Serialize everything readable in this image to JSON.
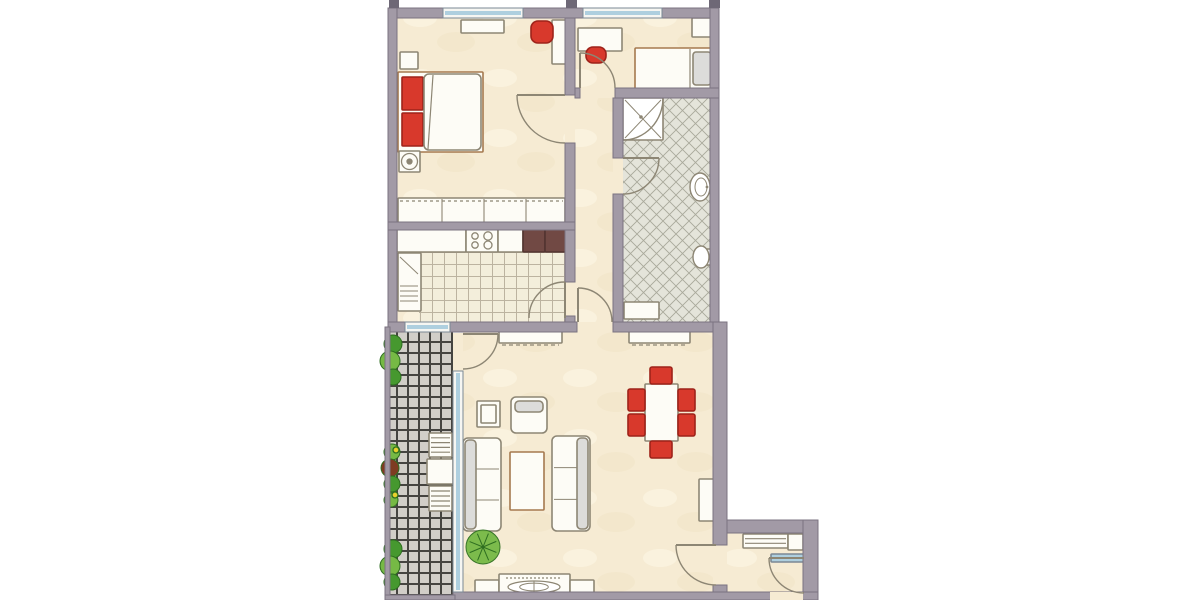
{
  "palette": {
    "wall": "#a29aa6",
    "wallEdge": "#7b7380",
    "stub": "#6e6876",
    "furn": "#fdfcf6",
    "line": "#8d8674",
    "tan": "#a5794f",
    "red": "#d8392c",
    "redDark": "#9e231a",
    "darkCounter": "#714944",
    "darkCounterStroke": "#533430",
    "grayLight": "#dcdcda",
    "windowBlue": "#aecfdf",
    "winFrame": "#f6f6f2",
    "sillStroke": "#7b8894",
    "green": "#46982f",
    "greenDark": "#2e6e20",
    "greenLight": "#76b945",
    "brownRed": "#7e3b22",
    "yellow": "#e8d12c",
    "cream": "#f6ebd3",
    "doorArc": "#8d8674",
    "white": "#ffffff"
  },
  "canvas": {
    "w": 1200,
    "h": 600
  },
  "floors": [
    {
      "n": "floor-bedroom",
      "r": [
        397,
        18,
        168,
        204
      ],
      "f": "cream"
    },
    {
      "n": "floor-kids-room",
      "r": [
        575,
        18,
        135,
        70
      ],
      "f": "cream"
    },
    {
      "n": "floor-hallway",
      "r": [
        575,
        88,
        38,
        234
      ],
      "f": "cream"
    },
    {
      "n": "floor-bathroom",
      "r": [
        623,
        98,
        87,
        224
      ],
      "f": "bath"
    },
    {
      "n": "floor-kitchen",
      "r": [
        397,
        230,
        168,
        92
      ],
      "f": "cream"
    },
    {
      "n": "floor-kitchen-tiles",
      "r": [
        419,
        252,
        146,
        70
      ],
      "f": "checker"
    },
    {
      "n": "floor-living-room",
      "r": [
        463,
        332,
        250,
        260
      ],
      "f": "cream"
    },
    {
      "n": "floor-entry",
      "r": [
        727,
        533,
        76,
        59
      ],
      "f": "cream"
    },
    {
      "n": "floor-balcony",
      "r": [
        390,
        330,
        63,
        266
      ],
      "f": "balcony"
    },
    {
      "n": "gap-bedroom-door",
      "r": [
        565,
        95,
        10,
        48
      ],
      "f": "flat"
    },
    {
      "n": "gap-kids-door",
      "r": [
        580,
        88,
        35,
        10
      ],
      "f": "flat"
    },
    {
      "n": "gap-bath-door",
      "r": [
        613,
        158,
        10,
        36
      ],
      "f": "flat"
    },
    {
      "n": "gap-kitchen-door",
      "r": [
        565,
        282,
        10,
        34
      ],
      "f": "flat"
    },
    {
      "n": "gap-hall-living-door",
      "r": [
        577,
        322,
        36,
        10
      ],
      "f": "flat"
    },
    {
      "n": "gap-balcony-door",
      "r": [
        453,
        333,
        10,
        38
      ],
      "f": "flat"
    },
    {
      "n": "gap-living-entry-door",
      "r": [
        713,
        545,
        14,
        40
      ],
      "f": "flat"
    }
  ],
  "furniture": [
    {
      "t": "rect",
      "n": "nightstand",
      "r": [
        400,
        52,
        18,
        17
      ]
    },
    {
      "t": "rect",
      "n": "double-bed-frame",
      "r": [
        398,
        72,
        85,
        80
      ],
      "stroke": "tan"
    },
    {
      "t": "rect",
      "n": "bed-pillow-1",
      "r": [
        402,
        77,
        21,
        33
      ],
      "fill": "red",
      "stroke": "redDark"
    },
    {
      "t": "rect",
      "n": "bed-pillow-2",
      "r": [
        402,
        113,
        21,
        33
      ],
      "fill": "red",
      "stroke": "redDark"
    },
    {
      "t": "rect",
      "n": "bed-duvet",
      "r": [
        424,
        74,
        57,
        76
      ],
      "rx": 5
    },
    {
      "t": "line",
      "n": "duvet-fold",
      "p": [
        433,
        75,
        428,
        149
      ]
    },
    {
      "t": "rect",
      "n": "stool-base",
      "r": [
        399,
        151,
        21,
        21
      ]
    },
    {
      "t": "circle",
      "n": "stool-seat",
      "c": [
        409.5,
        161.5,
        8
      ]
    },
    {
      "t": "circle",
      "n": "stool-knob",
      "c": [
        409.5,
        161.5,
        2.5
      ],
      "fill": "line"
    },
    {
      "t": "rect",
      "n": "wall-shelf-bedroom",
      "r": [
        461,
        20,
        43,
        13
      ]
    },
    {
      "t": "rect",
      "n": "desk-bedroom",
      "r": [
        552,
        20,
        15,
        44
      ]
    },
    {
      "t": "chairRed",
      "n": "office-chair-bedroom",
      "r": [
        531,
        21,
        22,
        22
      ],
      "round": true
    },
    {
      "t": "rectLines",
      "n": "wardrobe-row",
      "r": [
        398,
        198,
        167,
        25
      ],
      "vlines": [
        442,
        484,
        526
      ]
    },
    {
      "t": "line",
      "n": "wardrobe-rail",
      "p": [
        400,
        201,
        563,
        201
      ],
      "dash": "3,3"
    },
    {
      "t": "rect",
      "n": "desk-kids",
      "r": [
        578,
        28,
        44,
        23
      ]
    },
    {
      "t": "chairRed",
      "n": "chair-kids",
      "r": [
        586,
        47,
        20,
        16
      ],
      "round": true
    },
    {
      "t": "rect",
      "n": "single-bed-kids",
      "r": [
        635,
        48,
        78,
        41
      ],
      "stroke": "tan"
    },
    {
      "t": "line",
      "n": "single-bed-line",
      "p": [
        690,
        49,
        690,
        88
      ]
    },
    {
      "t": "rect",
      "n": "pillow-kids",
      "r": [
        693,
        52,
        18,
        33
      ],
      "fill": "grayLight",
      "rx": 3
    },
    {
      "t": "rect",
      "n": "wardrobe-kids",
      "r": [
        692,
        18,
        20,
        19
      ]
    },
    {
      "t": "shower",
      "n": "shower",
      "r": [
        623,
        98,
        40,
        42
      ]
    },
    {
      "t": "sink",
      "n": "sink",
      "c": [
        700,
        187,
        10,
        14
      ]
    },
    {
      "t": "toilet",
      "n": "toilet",
      "c": [
        701,
        257,
        8,
        11
      ]
    },
    {
      "t": "rect",
      "n": "bath-cabinet",
      "r": [
        624,
        302,
        35,
        17
      ]
    },
    {
      "t": "rect",
      "n": "kitchen-counter-left",
      "r": [
        397,
        229,
        69,
        23
      ]
    },
    {
      "t": "stove",
      "n": "stove",
      "r": [
        466,
        229,
        32,
        23
      ]
    },
    {
      "t": "rect",
      "n": "kitchen-counter-mid",
      "r": [
        498,
        229,
        25,
        23
      ]
    },
    {
      "t": "rect",
      "n": "kitchen-counter-dark-1",
      "r": [
        523,
        229,
        22,
        23
      ],
      "fill": "darkCounter",
      "stroke": "darkCounterStroke"
    },
    {
      "t": "rect",
      "n": "kitchen-counter-dark-2",
      "r": [
        545,
        229,
        21,
        23
      ],
      "fill": "darkCounter",
      "stroke": "darkCounterStroke"
    },
    {
      "t": "fridge",
      "n": "fridge",
      "r": [
        398,
        253,
        23,
        58
      ]
    },
    {
      "t": "rect",
      "n": "sideboard-1",
      "r": [
        499,
        329,
        63,
        14
      ]
    },
    {
      "t": "line",
      "n": "sideboard-1-edge",
      "p": [
        502,
        345,
        559,
        345
      ],
      "dash": "4,3"
    },
    {
      "t": "rect",
      "n": "sideboard-2",
      "r": [
        629,
        329,
        61,
        14
      ]
    },
    {
      "t": "line",
      "n": "sideboard-2-edge",
      "p": [
        632,
        345,
        687,
        345
      ],
      "dash": "4,3"
    },
    {
      "t": "rect",
      "n": "dining-table",
      "r": [
        645,
        384,
        33,
        57
      ]
    },
    {
      "t": "chairRed",
      "n": "dining-chair-top",
      "r": [
        650,
        367,
        22,
        17
      ]
    },
    {
      "t": "chairRed",
      "n": "dining-chair-bottom",
      "r": [
        650,
        441,
        22,
        17
      ]
    },
    {
      "t": "chairRed",
      "n": "dining-chair-left-1",
      "r": [
        628,
        389,
        17,
        22
      ]
    },
    {
      "t": "chairRed",
      "n": "dining-chair-left-2",
      "r": [
        628,
        414,
        17,
        22
      ]
    },
    {
      "t": "chairRed",
      "n": "dining-chair-right-1",
      "r": [
        678,
        389,
        17,
        22
      ]
    },
    {
      "t": "chairRed",
      "n": "dining-chair-right-2",
      "r": [
        678,
        414,
        17,
        22
      ]
    },
    {
      "t": "armchair",
      "n": "armchair",
      "r": [
        511,
        397,
        36,
        36
      ]
    },
    {
      "t": "rect",
      "n": "side-table",
      "r": [
        477,
        401,
        23,
        26
      ]
    },
    {
      "t": "rect",
      "n": "side-table-top",
      "r": [
        481,
        405,
        15,
        18
      ]
    },
    {
      "t": "sofa",
      "n": "sofa-left",
      "r": [
        463,
        438,
        38,
        93
      ],
      "back": "left"
    },
    {
      "t": "sofa",
      "n": "sofa-right",
      "r": [
        552,
        436,
        38,
        95
      ],
      "back": "right"
    },
    {
      "t": "rect",
      "n": "coffee-table",
      "r": [
        510,
        452,
        34,
        58
      ],
      "stroke": "tan"
    },
    {
      "t": "plantBurst",
      "n": "plant-living",
      "c": [
        483,
        547,
        17
      ]
    },
    {
      "t": "rect",
      "n": "tv-unit-left",
      "r": [
        475,
        580,
        24,
        18
      ]
    },
    {
      "t": "rect",
      "n": "tv-unit-center",
      "r": [
        499,
        574,
        71,
        24
      ]
    },
    {
      "t": "rect",
      "n": "tv-unit-right",
      "r": [
        570,
        580,
        24,
        18
      ]
    },
    {
      "t": "deco",
      "n": "stereo-deco",
      "c": [
        534,
        587,
        26,
        6
      ]
    },
    {
      "t": "line",
      "n": "tv-dash",
      "p": [
        506,
        578,
        562,
        578
      ],
      "dash": "2,2"
    },
    {
      "t": "rect",
      "n": "cabinet-living",
      "r": [
        699,
        479,
        16,
        42
      ]
    },
    {
      "t": "rectLines",
      "n": "entry-shelf",
      "r": [
        743,
        534,
        45,
        14
      ],
      "hlines": 2
    },
    {
      "t": "rect",
      "n": "entry-box",
      "r": [
        788,
        534,
        15,
        16
      ]
    },
    {
      "t": "rect",
      "n": "entry-mat",
      "r": [
        771,
        554,
        35,
        8
      ],
      "fill": "windowBlue",
      "stroke": "sillStroke"
    },
    {
      "t": "rect",
      "n": "balcony-table",
      "r": [
        427,
        459,
        26,
        25
      ]
    },
    {
      "t": "rectLines",
      "n": "balcony-chair-1",
      "r": [
        429,
        433,
        23,
        24
      ],
      "hlines": 4
    },
    {
      "t": "rectLines",
      "n": "balcony-chair-2",
      "r": [
        429,
        486,
        23,
        25
      ],
      "hlines": 4
    },
    {
      "t": "plants",
      "n": "balcony-plants-top",
      "circles": [
        [
          393,
          344,
          9,
          "green"
        ],
        [
          390,
          361,
          10,
          "greenLight"
        ],
        [
          393,
          377,
          8,
          "green"
        ]
      ]
    },
    {
      "t": "plants",
      "n": "balcony-plants-mid",
      "circles": [
        [
          392,
          452,
          8,
          "greenLight"
        ],
        [
          390,
          468,
          9,
          "brownRed"
        ],
        [
          392,
          484,
          8,
          "green"
        ],
        [
          391,
          500,
          7,
          "greenLight"
        ]
      ]
    },
    {
      "t": "plants",
      "n": "balcony-plants-bottom",
      "circles": [
        [
          393,
          549,
          9,
          "green"
        ],
        [
          390,
          566,
          10,
          "greenLight"
        ],
        [
          392,
          582,
          8,
          "green"
        ]
      ]
    },
    {
      "t": "circle",
      "n": "flower-yellow-1",
      "c": [
        396,
        450,
        3
      ],
      "fill": "yellow",
      "stroke": "greenDark"
    },
    {
      "t": "circle",
      "n": "flower-yellow-2",
      "c": [
        395,
        495,
        3
      ],
      "fill": "yellow",
      "stroke": "greenDark"
    }
  ],
  "walls": [
    {
      "n": "wall-top-a",
      "r": [
        388,
        8,
        55,
        10
      ]
    },
    {
      "n": "wall-top-b",
      "r": [
        523,
        8,
        60,
        10
      ]
    },
    {
      "n": "wall-top-c",
      "r": [
        662,
        8,
        57,
        10
      ]
    },
    {
      "n": "wall-left",
      "r": [
        388,
        8,
        9,
        319
      ]
    },
    {
      "n": "wall-right-upper",
      "r": [
        710,
        8,
        9,
        314
      ]
    },
    {
      "n": "wall-bedroom-kitchen",
      "r": [
        388,
        222,
        187,
        8
      ]
    },
    {
      "n": "wall-bedroom-hall-a",
      "r": [
        565,
        18,
        10,
        77
      ]
    },
    {
      "n": "wall-bedroom-hall-b",
      "r": [
        565,
        143,
        10,
        79
      ]
    },
    {
      "n": "wall-kitchen-hall-a",
      "r": [
        565,
        230,
        10,
        52
      ]
    },
    {
      "n": "wall-kitchen-hall-b",
      "r": [
        565,
        316,
        10,
        8
      ]
    },
    {
      "n": "wall-kids-bottom-a",
      "r": [
        575,
        88,
        5,
        10
      ]
    },
    {
      "n": "wall-kids-bottom-b",
      "r": [
        615,
        88,
        104,
        10
      ]
    },
    {
      "n": "wall-bath-left-a",
      "r": [
        613,
        98,
        10,
        60
      ]
    },
    {
      "n": "wall-bath-left-b",
      "r": [
        613,
        194,
        10,
        128
      ]
    },
    {
      "n": "wall-living-top-a",
      "r": [
        388,
        322,
        17,
        10
      ]
    },
    {
      "n": "wall-living-top-b",
      "r": [
        450,
        322,
        127,
        10
      ]
    },
    {
      "n": "wall-living-top-c",
      "r": [
        613,
        322,
        114,
        10
      ]
    },
    {
      "n": "wall-living-right",
      "r": [
        713,
        322,
        14,
        223
      ]
    },
    {
      "n": "wall-living-right-low",
      "r": [
        713,
        585,
        14,
        15
      ]
    },
    {
      "n": "wall-entry-top",
      "r": [
        727,
        520,
        80,
        13
      ]
    },
    {
      "n": "wall-entry-right",
      "r": [
        803,
        520,
        15,
        80
      ]
    },
    {
      "n": "wall-bottom",
      "r": [
        453,
        592,
        365,
        8
      ]
    },
    {
      "n": "wall-balcony-rail-left",
      "r": [
        385,
        327,
        5,
        273
      ]
    },
    {
      "n": "wall-balcony-rail-bottom",
      "r": [
        385,
        595,
        70,
        5
      ]
    }
  ],
  "gaps_after_walls": [
    {
      "n": "gap-front-door",
      "r": [
        770,
        592,
        33,
        8
      ]
    }
  ],
  "stubs": [
    {
      "n": "stub-top-left",
      "r": [
        389,
        0,
        10,
        8
      ]
    },
    {
      "n": "stub-top-mid",
      "r": [
        566,
        0,
        11,
        8
      ]
    },
    {
      "n": "stub-top-right",
      "r": [
        709,
        0,
        11,
        8
      ]
    }
  ],
  "windows": [
    {
      "n": "window-bedroom",
      "r": [
        443,
        8,
        80,
        10
      ]
    },
    {
      "n": "window-kids",
      "r": [
        583,
        8,
        79,
        10
      ]
    },
    {
      "n": "window-kitchen-balcony",
      "r": [
        405,
        322,
        45,
        10
      ]
    },
    {
      "n": "window-living-balcony",
      "r": [
        453,
        371,
        10,
        221
      ]
    }
  ],
  "doors": [
    {
      "n": "door-bedroom",
      "d": "M517,95 A48,48 0 0 0 565,143",
      "leaf": [
        517,
        95,
        565,
        95
      ]
    },
    {
      "n": "door-kids",
      "d": "M580,53 A35,35 0 0 1 615,88",
      "leaf": [
        580,
        88,
        580,
        53
      ]
    },
    {
      "n": "door-bathroom",
      "d": "M659,158 A36,36 0 0 1 623,194",
      "leaf": [
        623,
        158,
        659,
        158
      ]
    },
    {
      "n": "door-kitchen",
      "d": "M565,282 A36,36 0 0 0 529,318",
      "leaf": [
        565,
        318,
        565,
        282
      ]
    },
    {
      "n": "door-hall-living",
      "d": "M578,288 A34,34 0 0 1 612,322",
      "leaf": [
        578,
        322,
        578,
        288
      ]
    },
    {
      "n": "door-balcony",
      "d": "M498,334 A35,35 0 0 1 463,369",
      "leaf": [
        463,
        334,
        498,
        334
      ]
    },
    {
      "n": "door-living-entry",
      "d": "M676,545 A40,40 0 0 0 716,585",
      "leaf": [
        716,
        545,
        676,
        545
      ]
    },
    {
      "n": "door-front",
      "d": "M769,558 A35,35 0 0 0 804,593",
      "leaf": [
        804,
        558,
        769,
        558
      ]
    }
  ]
}
